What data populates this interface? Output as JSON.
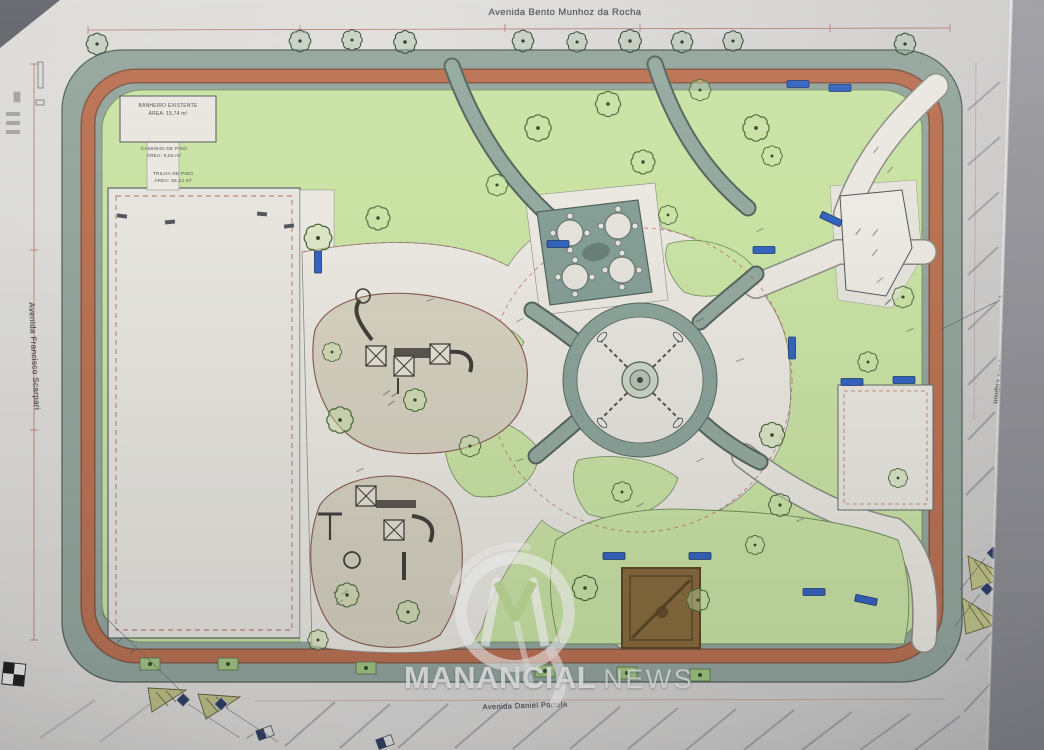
{
  "streets": {
    "top": "Avenida Bento Munhoz da Rocha",
    "bottom": "Avenida Daniel Portela",
    "left": "Avenida Francisco Scarpari",
    "right": "Avenida Moysés Lupion"
  },
  "plan_labels": {
    "restroom_line1": "BANHEIRO EXISTENTE",
    "restroom_line2": "ÁREA: 15,74 m²",
    "walkway_line1": "CAMINHO DE PISO",
    "walkway_line2": "ÁREA: 9,60 m²",
    "trail_line1": "TRILHA DE PISO",
    "trail_line2": "ÁREA: 56,12 m²"
  },
  "watermark": {
    "brand": "MANANCIAL",
    "suffix": "NEWS"
  },
  "colors": {
    "sidewalk": "#93a89f",
    "running_track": "#c2704e",
    "lawn": "#cbe7a2",
    "path": "#edebe2",
    "playground": "#d9d4c0",
    "bench_blue": "#2f63c9",
    "sand_area": "#8a6a35",
    "dimension_red": "#c0504a",
    "paper": "#d9d8d5"
  }
}
